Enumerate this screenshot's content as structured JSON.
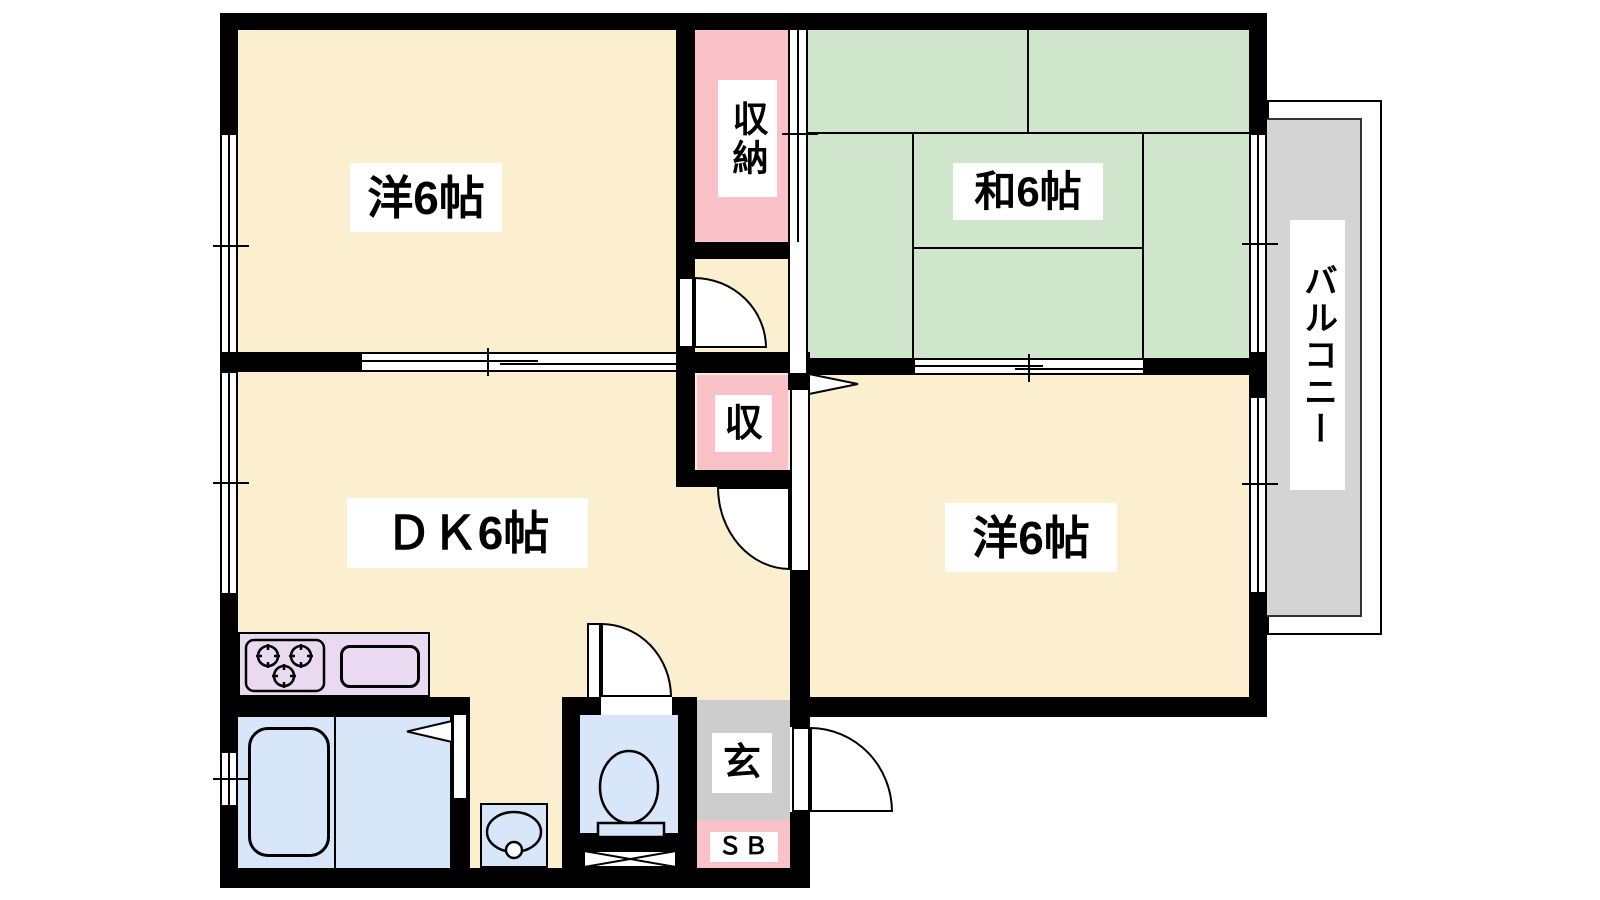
{
  "rooms": {
    "western1": "洋6帖",
    "washitsu": "和6帖",
    "dk": "ＤＫ6帖",
    "western2": "洋6帖",
    "balcony": "バルコニー",
    "closet_large": "収納",
    "closet_small": "収",
    "entrance": "玄",
    "shoe_box": "ＳＢ"
  },
  "fixtures": {
    "stove": "three-burner-stove",
    "sink": "kitchen-sink",
    "bathtub": "bathtub",
    "toilet": "toilet",
    "washbasin": "washbasin",
    "louver_window": "x-window"
  },
  "colors": {
    "room_floor": "#FBEFD0",
    "tatami_green": "#D0E6CC",
    "closet_pink": "#FAC2C8",
    "kitchen_lavender": "#E9DAF1",
    "wet_blue": "#D7E6F8",
    "balcony_gray": "#D4D4D4",
    "entrance_gray": "#CDCDCD",
    "wall": "#000000"
  }
}
